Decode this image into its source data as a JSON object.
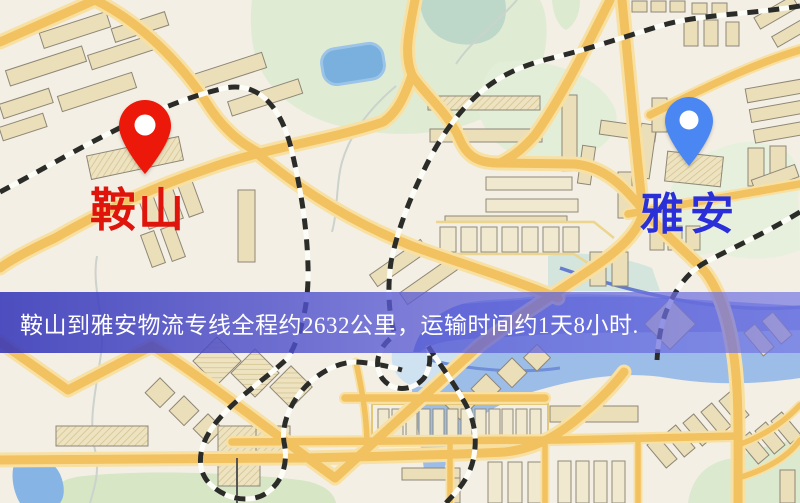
{
  "map": {
    "markers": [
      {
        "id": "anshan",
        "label": "鞍山",
        "pin": "red-pin"
      },
      {
        "id": "yaan",
        "label": "雅安",
        "pin": "blue-pin"
      }
    ]
  },
  "banner": {
    "text": "鞍山到雅安物流专线全程约2632公里，运输时间约1天8小时."
  },
  "colors": {
    "pin-red": "#ec1809",
    "label-red": "#df140b",
    "pin-blue": "#4a87f2",
    "label-blue": "#2a2fd8",
    "banner-bg": "#5455cf",
    "banner-text": "#ffffff"
  }
}
